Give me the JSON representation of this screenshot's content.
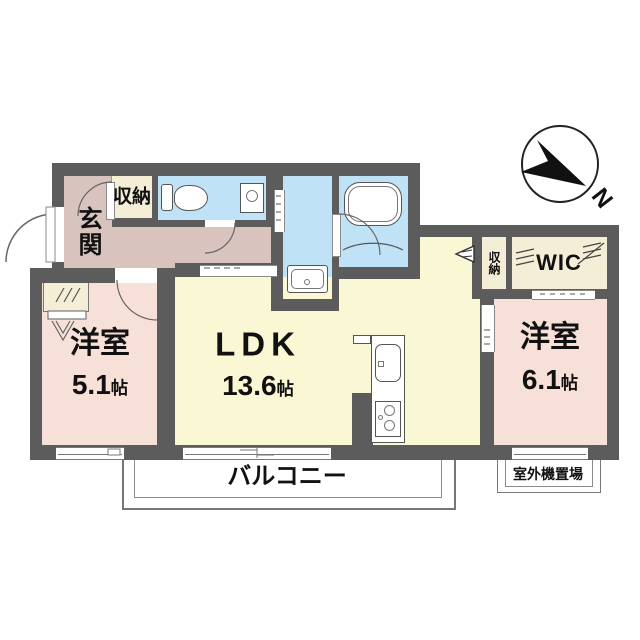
{
  "floorplan": {
    "compass": {
      "label": "N"
    },
    "rooms": {
      "entrance": {
        "label": "玄関"
      },
      "hall_storage": {
        "label": "収納"
      },
      "toilet": {
        "label": ""
      },
      "bedroom_left": {
        "label": "洋室",
        "size_num": "5.1",
        "size_unit": "帖"
      },
      "ldk": {
        "label": "LDK",
        "size_num": "13.6",
        "size_unit": "帖"
      },
      "bedroom_right": {
        "label": "洋室",
        "size_num": "6.1",
        "size_unit": "帖"
      },
      "storage_right": {
        "label": "収納"
      },
      "wic": {
        "label": "WIC"
      },
      "balcony": {
        "label": "バルコニー"
      },
      "outdoor_unit": {
        "label": "室外機置場"
      }
    },
    "colors": {
      "wall": "#5c5c5c",
      "hall_pink": "#d9c3be",
      "bedroom_pink": "#f6e0d8",
      "ldk_yellow": "#faf8d4",
      "wet_blue": "#bfe2f6",
      "closet_cream": "#f4eed6"
    }
  }
}
